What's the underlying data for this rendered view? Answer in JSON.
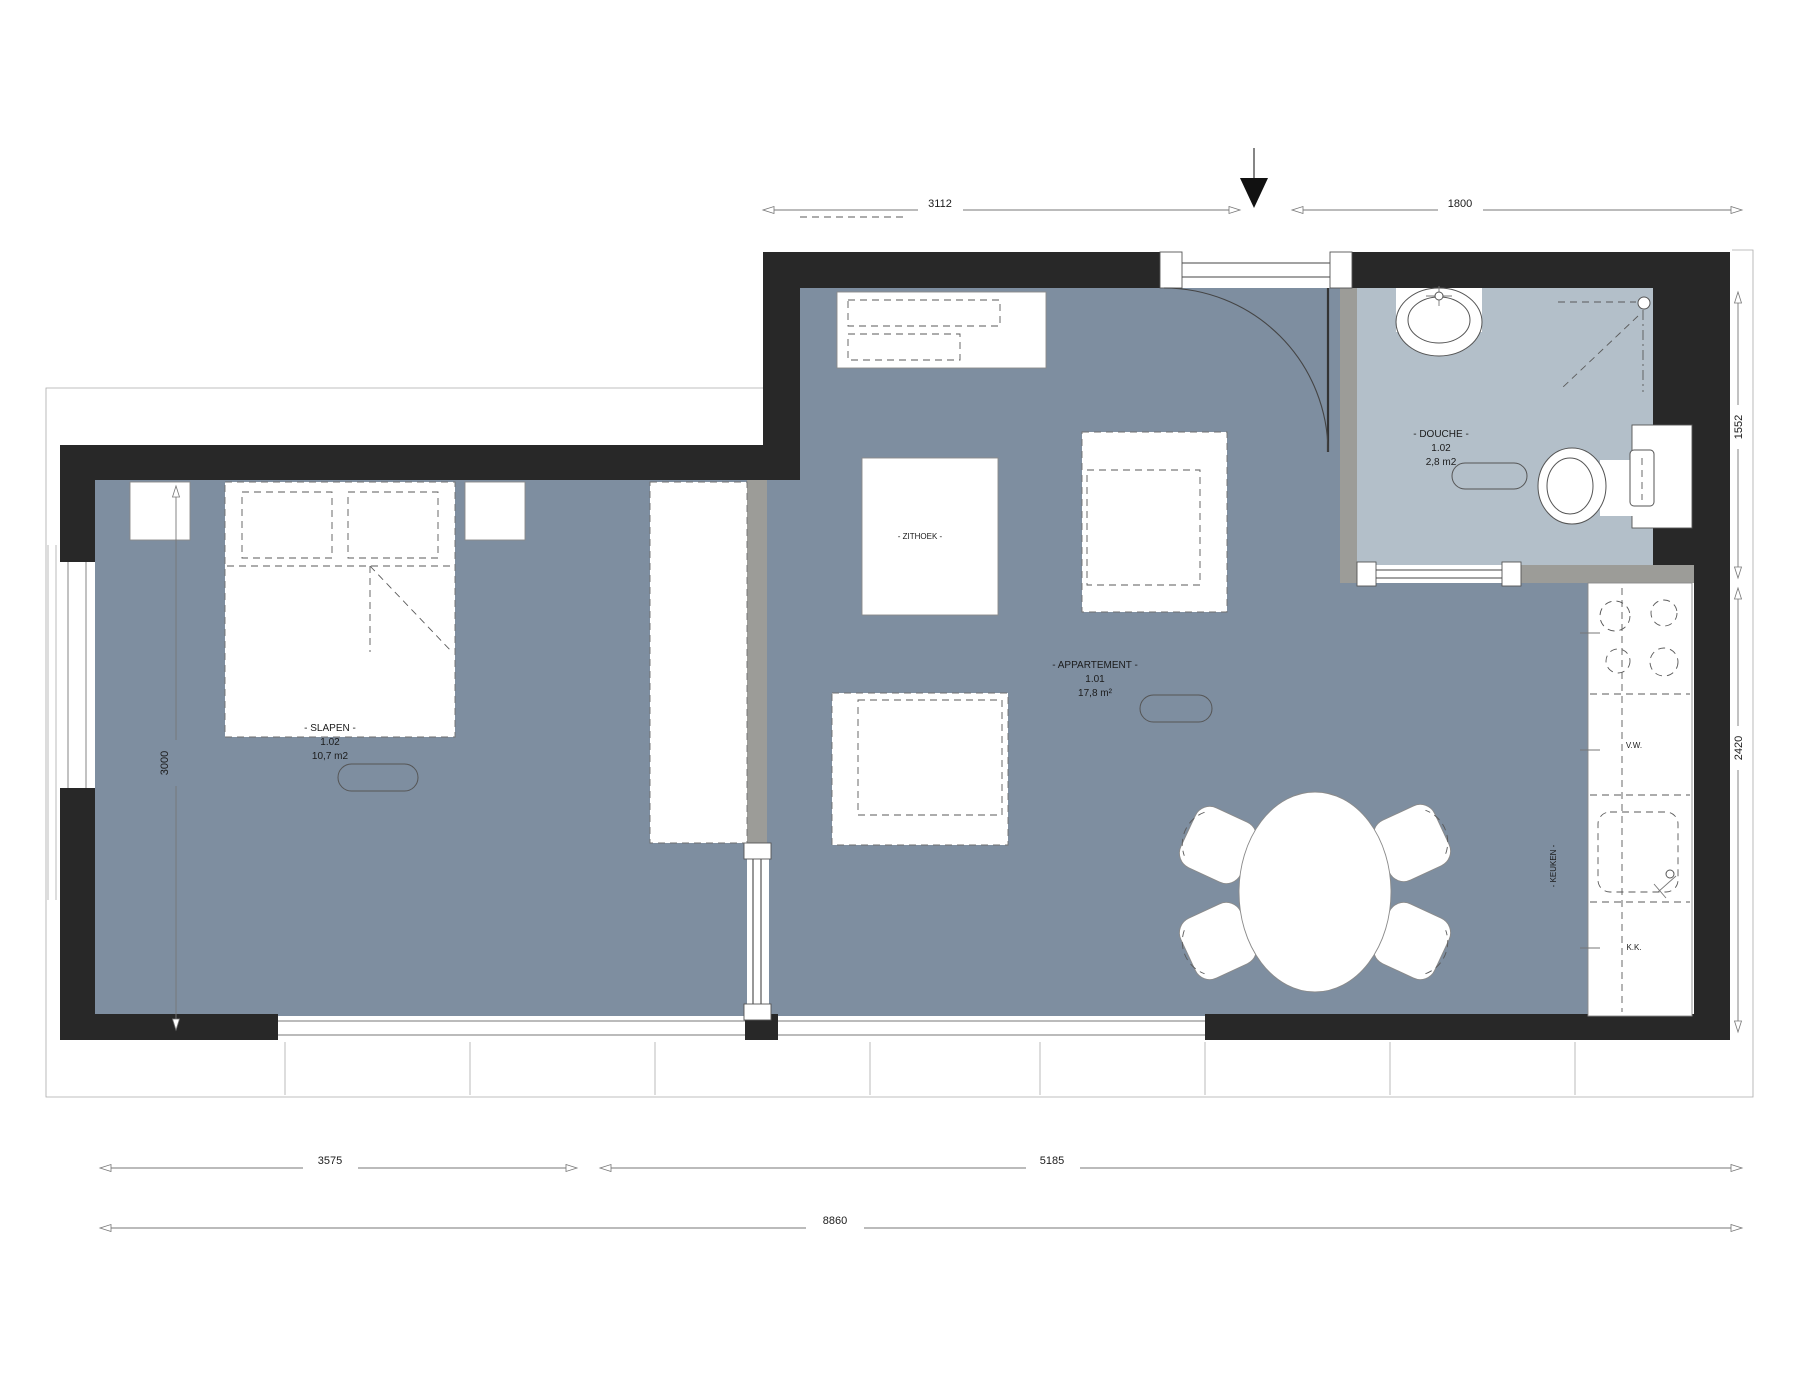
{
  "drawing_type": "apartment floor plan",
  "colors": {
    "paper": "#FFFFFF",
    "floor_main": "#7E8EA0",
    "floor_shower": "#B3BFC9",
    "wall_dark": "#282828",
    "wall_light": "#9C9C98",
    "line": "#777777"
  },
  "rooms": {
    "apartment": {
      "name": "- APPARTEMENT -",
      "number": "1.01",
      "area": "17,8 m²"
    },
    "bedroom": {
      "name": "- SLAPEN -",
      "number": "1.02",
      "area": "10,7 m2"
    },
    "shower": {
      "name": "- DOUCHE -",
      "number": "1.02",
      "area": "2,8 m2"
    },
    "seating": {
      "name": "- ZITHOEK -"
    },
    "kitchen": {
      "name": "- KEUKEN -",
      "dishwasher_abbr": "V.W.",
      "fridge_abbr": "K.K."
    }
  },
  "dimensions": {
    "top_left": "3112",
    "top_right": "1800",
    "side_right_upper": "1552",
    "side_right_lower": "2420",
    "side_left": "3000",
    "bottom_left": "3575",
    "bottom_right": "5185",
    "bottom_total": "8860"
  }
}
